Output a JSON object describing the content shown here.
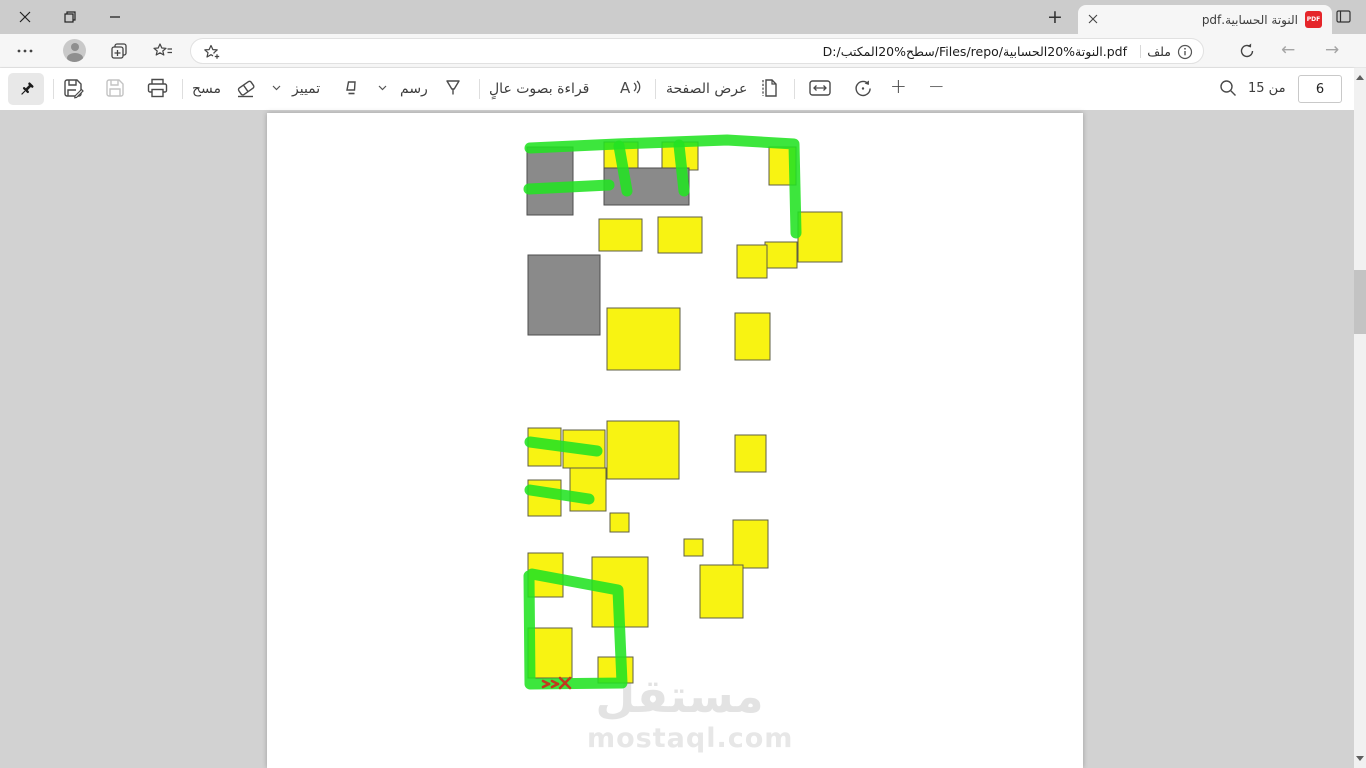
{
  "titlebar": {
    "tab": {
      "title": "النوتة الحسابية.pdf",
      "favicon_label": "PDF"
    },
    "new_tab_glyph": "+"
  },
  "navbar": {
    "back_glyph": "←",
    "forward_glyph": "→",
    "address": {
      "url": "D:/سطح%20المكتب/Files/repo/النوتة%20الحسابية.pdf",
      "file_label": "ملف"
    }
  },
  "pdf_toolbar": {
    "erase_label": "مسح",
    "highlight_label": "تمييز",
    "draw_label": "رسم",
    "read_aloud_label": "قراءة بصوت عالٍ",
    "page_view_label": "عرض الصفحة",
    "zoom_in_glyph": "+",
    "zoom_out_glyph": "−",
    "page_current": "6",
    "page_total_label": "من 15"
  },
  "watermark": {
    "arabic": "مستقل",
    "latin": "mostaql.com"
  },
  "icons": {
    "titlebar": [
      "close-icon",
      "restore-icon",
      "minimize-icon",
      "tab-close-icon",
      "pdf-favicon",
      "new-tab-icon",
      "tab-actions-icon"
    ],
    "navbar": [
      "more-menu-icon",
      "avatar",
      "collections-icon",
      "favorites-icon",
      "add-favorite-star-icon",
      "info-icon",
      "file-badge",
      "refresh-icon",
      "back-icon",
      "forward-icon"
    ],
    "pdf_toolbar": [
      "pin-icon",
      "save-as-icon",
      "save-icon",
      "print-icon",
      "eraser-icon",
      "highlighter-icon",
      "pen-icon",
      "read-aloud-icon",
      "page-view-icon",
      "fit-width-icon",
      "rotate-icon",
      "zoom-in-icon",
      "zoom-out-icon",
      "search-icon"
    ]
  },
  "page_shapes": {
    "colors": {
      "yellow": "#f8f312",
      "yellow_border": "#5f5f45",
      "gray": "#8a8a8a",
      "gray_border": "#4e4e4e",
      "green": "#22e322",
      "red": "#c03a1e"
    },
    "rects": [
      [
        260,
        34,
        46,
        68,
        "g"
      ],
      [
        337,
        29,
        34,
        28,
        "y"
      ],
      [
        395,
        29,
        36,
        28,
        "y"
      ],
      [
        337,
        55,
        85,
        37,
        "g"
      ],
      [
        502,
        34,
        27,
        38,
        "y"
      ],
      [
        332,
        106,
        43,
        32,
        "y"
      ],
      [
        391,
        104,
        44,
        36,
        "y"
      ],
      [
        531,
        99,
        44,
        50,
        "y"
      ],
      [
        498,
        129,
        32,
        26,
        "y"
      ],
      [
        470,
        132,
        30,
        33,
        "y"
      ],
      [
        261,
        142,
        72,
        80,
        "g"
      ],
      [
        340,
        195,
        73,
        62,
        "y"
      ],
      [
        468,
        200,
        35,
        47,
        "y"
      ],
      [
        261,
        315,
        33,
        38,
        "y"
      ],
      [
        296,
        317,
        42,
        38,
        "y"
      ],
      [
        340,
        308,
        72,
        58,
        "y"
      ],
      [
        468,
        322,
        31,
        37,
        "y"
      ],
      [
        261,
        367,
        33,
        36,
        "y"
      ],
      [
        303,
        355,
        36,
        43,
        "y"
      ],
      [
        343,
        400,
        19,
        19,
        "y"
      ],
      [
        417,
        426,
        19,
        17,
        "y"
      ],
      [
        466,
        407,
        35,
        48,
        "y"
      ],
      [
        261,
        440,
        35,
        44,
        "y"
      ],
      [
        325,
        444,
        56,
        70,
        "y"
      ],
      [
        433,
        452,
        43,
        53,
        "y"
      ],
      [
        261,
        515,
        44,
        50,
        "y"
      ],
      [
        331,
        544,
        35,
        26,
        "y"
      ]
    ],
    "strokes": [
      [
        [
          263,
          35
        ],
        [
          350,
          31
        ],
        [
          460,
          27
        ],
        [
          527,
          31
        ],
        [
          529,
          120
        ]
      ],
      [
        [
          352,
          33
        ],
        [
          360,
          78
        ]
      ],
      [
        [
          412,
          32
        ],
        [
          417,
          78
        ]
      ],
      [
        [
          262,
          76
        ],
        [
          342,
          72
        ]
      ],
      [
        [
          263,
          329
        ],
        [
          330,
          338
        ]
      ],
      [
        [
          263,
          377
        ],
        [
          322,
          386
        ]
      ],
      [
        [
          265,
          461
        ],
        [
          351,
          477
        ],
        [
          355,
          570
        ],
        [
          263,
          571
        ],
        [
          262,
          463
        ]
      ]
    ],
    "red_lines": [
      [
        [
          293,
          565
        ],
        [
          303,
          575
        ]
      ],
      [
        [
          303,
          565
        ],
        [
          293,
          575
        ]
      ],
      [
        [
          276,
          568
        ],
        [
          282,
          571
        ]
      ],
      [
        [
          282,
          571
        ],
        [
          276,
          574
        ]
      ],
      [
        [
          285,
          568
        ],
        [
          291,
          571
        ]
      ],
      [
        [
          291,
          571
        ],
        [
          285,
          574
        ]
      ]
    ]
  }
}
